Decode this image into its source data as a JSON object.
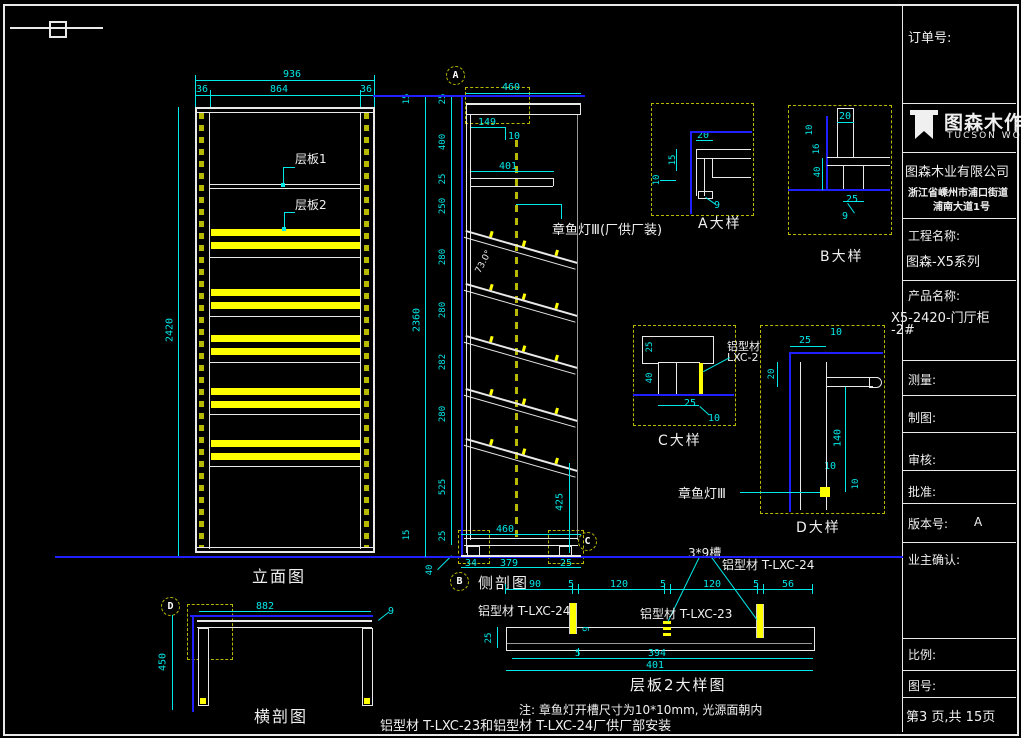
{
  "colors": {
    "background": "#000000",
    "line": "#ffffff",
    "dimension": "#00e8e8",
    "highlight": "#ffff00",
    "datum_blue": "#2020ff",
    "hidden_olive": "#b8b800"
  },
  "drawing": {
    "elevation": {
      "title": "立面图",
      "shelf1": "层板1",
      "shelf2": "层板2",
      "dim_total_width": "936",
      "dim_left": "36",
      "dim_center": "864",
      "dim_right": "36",
      "dim_height": "2420"
    },
    "side": {
      "title": "侧剖图",
      "lamp_label": "章鱼灯Ⅲ(厂供厂装)",
      "angle": "73.0°",
      "dim_top": "460",
      "dim_149": "149",
      "dim_10": "10",
      "dim_401": "401",
      "chain": [
        "25",
        "400",
        "25",
        "250",
        "280",
        "280",
        "282",
        "280",
        "525",
        "25"
      ],
      "dim_15_top": "15",
      "dim_2360": "2360",
      "dim_15_bottom": "15",
      "dim_40": "40",
      "dim_425": "425",
      "dim_460b": "460",
      "dim_34": "34",
      "dim_379": "379",
      "dim_25b": "25"
    },
    "callouts": {
      "a": "A",
      "b": "B",
      "c": "C",
      "d": "D"
    },
    "detail_a": {
      "title": "A大样",
      "d20": "20",
      "d15": "15",
      "d10": "10",
      "d9": "9"
    },
    "detail_b": {
      "title": "B大样",
      "d20": "20",
      "d10": "10",
      "d16": "16",
      "d40": "40",
      "d25": "25",
      "d9": "9"
    },
    "detail_c": {
      "title": "C大样",
      "mat1": "铝型材",
      "mat2": "LXC-2",
      "d25v": "25",
      "d40": "40",
      "d25": "25",
      "d10": "10"
    },
    "detail_d": {
      "title": "D大样",
      "lamp": "章鱼灯Ⅲ",
      "d25": "25",
      "d10a": "10",
      "d20": "20",
      "d140": "140",
      "d10b": "10",
      "d10c": "10"
    },
    "cross": {
      "title": "横剖图",
      "dim_width": "882",
      "dim_height": "450",
      "d9": "9"
    },
    "shelf2": {
      "title": "层板2大样图",
      "groove": "3*9槽",
      "mat_right": "铝型材 T-LXC-24",
      "mat_left": "铝型材 T-LXC-24",
      "mat_mid": "铝型材 T-LXC-23",
      "chain": [
        "90",
        "5",
        "120",
        "5",
        "120",
        "5",
        "56"
      ],
      "d25": "25",
      "d9": "9",
      "d5": "5",
      "d394": "394",
      "d401": "401"
    },
    "notes": {
      "line1": "注: 章鱼灯开槽尺寸为10*10mm, 光源面朝内",
      "line2": "铝型材 T-LXC-23和铝型材 T-LXC-24厂供厂部安装"
    }
  },
  "title_block": {
    "order_label": "订单号:",
    "logo_name": "图森木作",
    "logo_sub": "TUCSON WOOD",
    "company": "图森木业有限公司",
    "address_line1": "浙江省嵊州市浦口街道",
    "address_line2": "浦南大道1号",
    "project_label": "工程名称:",
    "project_name": "图森-X5系列",
    "product_label": "产品名称:",
    "product_name": "X5-2420-门厅柜",
    "product_name2": "-2#",
    "measure_label": "测量:",
    "draft_label": "制图:",
    "review_label": "审核:",
    "approve_label": "批准:",
    "version_label": "版本号:",
    "version_value": "A",
    "owner_label": "业主确认:",
    "scale_label": "比例:",
    "drawing_no_label": "图号:",
    "page_info": "第3 页,共 15页"
  }
}
